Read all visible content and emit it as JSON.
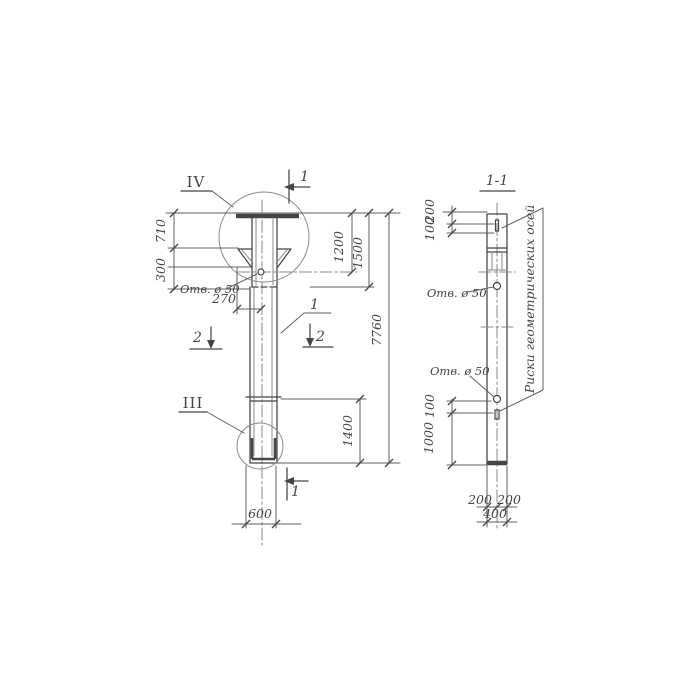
{
  "colors": {
    "ink": "#454545",
    "ink_light": "#8a8a8a",
    "paper": "#ffffff"
  },
  "left_view": {
    "detail_top_label": "IV",
    "detail_bottom_label": "III",
    "section_top": "1",
    "section_bottom": "1",
    "section_left": "2",
    "section_right": "2",
    "part_callout": "1",
    "hole_label": "Отв. ø 50",
    "dims": {
      "h710": "710",
      "h300": "300",
      "w270": "270",
      "h1200": "1200",
      "h1500": "1500",
      "h7760": "7760",
      "h1400": "1400",
      "w600": "600"
    }
  },
  "section_view": {
    "title": "1-1",
    "hole_label_upper": "Отв. ø 50",
    "hole_label_lower": "Отв. ø 50",
    "axes_note": "Риски геометрических осей",
    "dims": {
      "t200": "200",
      "t100": "100",
      "b100": "100",
      "b1000": "1000",
      "w200l": "200",
      "w200r": "200",
      "w400": "400"
    }
  }
}
